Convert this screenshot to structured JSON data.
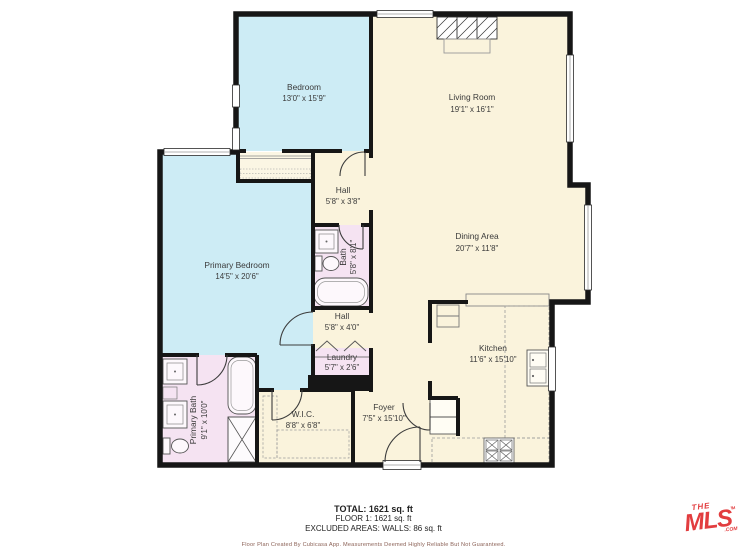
{
  "plan": {
    "rooms": [
      {
        "id": "bedroom",
        "name": "Bedroom",
        "dims": "13'0\" x 15'9\""
      },
      {
        "id": "living-room",
        "name": "Living Room",
        "dims": "19'1\" x 16'1\""
      },
      {
        "id": "hall-upper",
        "name": "Hall",
        "dims": "5'8\" x 3'8\""
      },
      {
        "id": "bath",
        "name": "Bath",
        "dims": "5'8\" x 8'1\""
      },
      {
        "id": "primary-bedroom",
        "name": "Primary Bedroom",
        "dims": "14'5\" x 20'6\""
      },
      {
        "id": "dining-area",
        "name": "Dining Area",
        "dims": "20'7\" x 11'8\""
      },
      {
        "id": "hall-lower",
        "name": "Hall",
        "dims": "5'8\" x 4'0\""
      },
      {
        "id": "laundry",
        "name": "Laundry",
        "dims": "5'7\" x 2'6\""
      },
      {
        "id": "kitchen",
        "name": "Kitchen",
        "dims": "11'6\" x 15'10\""
      },
      {
        "id": "primary-bath",
        "name": "Primary Bath",
        "dims": "9'1\" x 10'0\""
      },
      {
        "id": "wic",
        "name": "W.I.C.",
        "dims": "8'8\" x 6'8\""
      },
      {
        "id": "foyer",
        "name": "Foyer",
        "dims": "7'5\" x 15'10\""
      }
    ],
    "colors": {
      "room_default": "#faf3dc",
      "room_bedroom": "#cdecf5",
      "room_bath": "#f5e3f2",
      "wall": "#161616",
      "label_text": "#3a3a3a"
    }
  },
  "summary": {
    "total": "TOTAL: 1621 sq. ft",
    "floor": "FLOOR 1: 1621 sq. ft",
    "excluded": "EXCLUDED AREAS: WALLS: 86 sq. ft"
  },
  "disclaimer": "Floor Plan Created By Cubicasa App. Measurements Deemed Highly Reliable But Not Guaranteed.",
  "logo": {
    "the": "THE",
    "mls": "MLS",
    "tm": "TM",
    "com": ".COM",
    "color": "#e23d3f"
  }
}
